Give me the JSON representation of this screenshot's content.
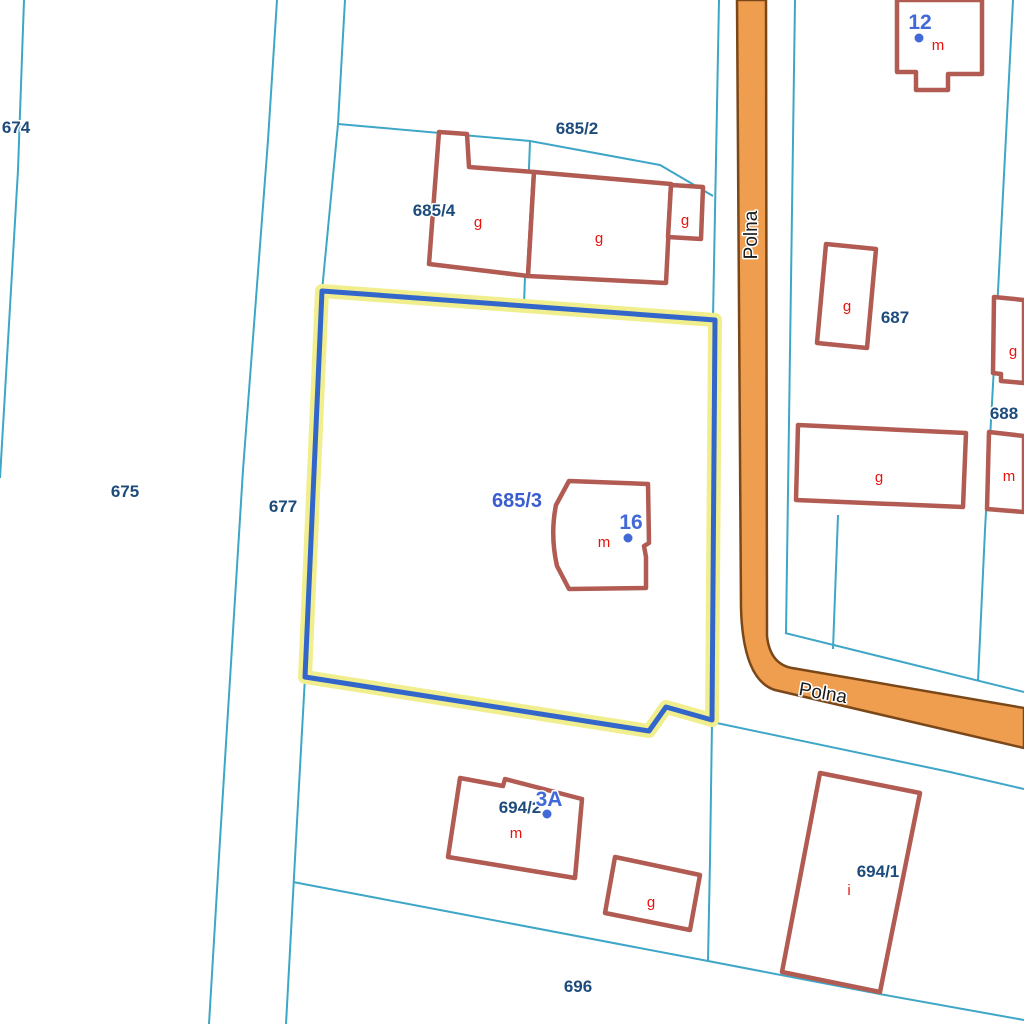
{
  "map": {
    "colors": {
      "background": "#ffffff",
      "parcel_line": "#3ea6c6",
      "building_stroke": "#b15b53",
      "building_fill": "#ffffff",
      "road_fill": "#ee9e4e",
      "road_stroke": "#7a4718",
      "highlight_halo": "#f1ee8e",
      "highlight_stroke": "#3366cb",
      "parcel_label": "#1d4c7c",
      "selected_label": "#3a5ed1",
      "address_label": "#4169d8",
      "building_letter": "#e8120d",
      "road_label": "#1a1a1a"
    },
    "road": {
      "name": "Polna",
      "path": "M 737,0 L 741,608 Q 743,680 775,690 L 1024,748 L 1024,708 L 792,668 Q 770,664 767,636 L 766,0 Z",
      "labels": [
        {
          "text": "Polna",
          "x": 757,
          "y": 235,
          "rotation": -90
        },
        {
          "text": "Polna",
          "x": 822,
          "y": 699,
          "rotation": 10
        }
      ]
    },
    "parcel_lines": [
      {
        "points": "24,0 18,170 0,478"
      },
      {
        "points": "277,0 268,140 243,470 220,840 209,1024"
      },
      {
        "points": "345,0 338,124 322,291"
      },
      {
        "points": "338,124 530,141 660,165 713,196"
      },
      {
        "points": "530,141 524,304"
      },
      {
        "points": "305,677 296,840 286,1024"
      },
      {
        "points": "719,0 713,318"
      },
      {
        "points": "795,0 786,633"
      },
      {
        "points": "1013,0 996,330 985,530 978,681"
      },
      {
        "points": "785,633 1024,692"
      },
      {
        "points": "712,722 950,772 1024,789"
      },
      {
        "points": "712,722 710,860 708,961"
      },
      {
        "points": "293,882 440,910 708,961 885,995 1024,1020"
      },
      {
        "points": "838,515 833,649"
      }
    ],
    "highlight": {
      "id": "685/3",
      "points": "322,291 715,320 712,720 666,707 649,731 305,677",
      "label": {
        "text": "685/3",
        "x": 517,
        "y": 507
      }
    },
    "buildings": [
      {
        "name": "building-12",
        "points": "897,0 897,72 916,72 916,90 948,90 948,74 982,74 982,0"
      },
      {
        "name": "building-685-4-left",
        "points": "439,132 467,134 469,167 534,172 528,276 429,264"
      },
      {
        "name": "building-685-4-right",
        "points": "534,172 671,184 666,283 528,276"
      },
      {
        "name": "building-685-4-annex",
        "points": "671,185 703,187 701,239 668,237"
      },
      {
        "name": "building-16",
        "path": "M 569,481 L 648,484 L 649,543 L 644,546 L 646,557 L 646,588 L 569,589 L 557,566 Q 550,535 556,505 Z"
      },
      {
        "name": "building-694-2",
        "points": "460,778 503,786 505,779 582,799 575,878 448,857"
      },
      {
        "name": "building-g-small",
        "points": "615,857 700,875 690,930 605,913"
      },
      {
        "name": "building-694-1",
        "points": "820,773 920,793 880,992 782,972"
      },
      {
        "name": "building-687-g",
        "points": "826,244 876,249 867,348 817,343"
      },
      {
        "name": "building-g-right-top",
        "points": "994,297 1024,300 1024,383 1001,381 1001,374 993,373"
      },
      {
        "name": "building-g-wide",
        "points": "798,425 966,433 963,507 796,500"
      },
      {
        "name": "building-m-right",
        "points": "989,432 1024,436 1024,512 987,509"
      }
    ],
    "building_letters": [
      {
        "text": "g",
        "x": 478,
        "y": 227
      },
      {
        "text": "g",
        "x": 599,
        "y": 243
      },
      {
        "text": "g",
        "x": 685,
        "y": 225
      },
      {
        "text": "m",
        "x": 938,
        "y": 50
      },
      {
        "text": "m",
        "x": 604,
        "y": 547
      },
      {
        "text": "g",
        "x": 847,
        "y": 311
      },
      {
        "text": "g",
        "x": 1013,
        "y": 356
      },
      {
        "text": "g",
        "x": 879,
        "y": 482
      },
      {
        "text": "m",
        "x": 1009,
        "y": 481
      },
      {
        "text": "m",
        "x": 516,
        "y": 838
      },
      {
        "text": "g",
        "x": 651,
        "y": 907
      },
      {
        "text": "i",
        "x": 849,
        "y": 895
      }
    ],
    "parcel_labels": [
      {
        "text": "674",
        "x": 16,
        "y": 133
      },
      {
        "text": "675",
        "x": 125,
        "y": 497
      },
      {
        "text": "677",
        "x": 283,
        "y": 512
      },
      {
        "text": "685/2",
        "x": 577,
        "y": 134
      },
      {
        "text": "685/4",
        "x": 434,
        "y": 216
      },
      {
        "text": "687",
        "x": 895,
        "y": 323
      },
      {
        "text": "688",
        "x": 1004,
        "y": 419
      },
      {
        "text": "694/2",
        "x": 520,
        "y": 813
      },
      {
        "text": "694/1",
        "x": 878,
        "y": 877
      },
      {
        "text": "696",
        "x": 578,
        "y": 992
      }
    ],
    "addresses": [
      {
        "text": "12",
        "x": 920,
        "y": 29,
        "dot_x": 919,
        "dot_y": 38
      },
      {
        "text": "16",
        "x": 631,
        "y": 529,
        "dot_x": 628,
        "dot_y": 538
      },
      {
        "text": "3A",
        "x": 549,
        "y": 806,
        "dot_x": 547,
        "dot_y": 814
      }
    ]
  }
}
